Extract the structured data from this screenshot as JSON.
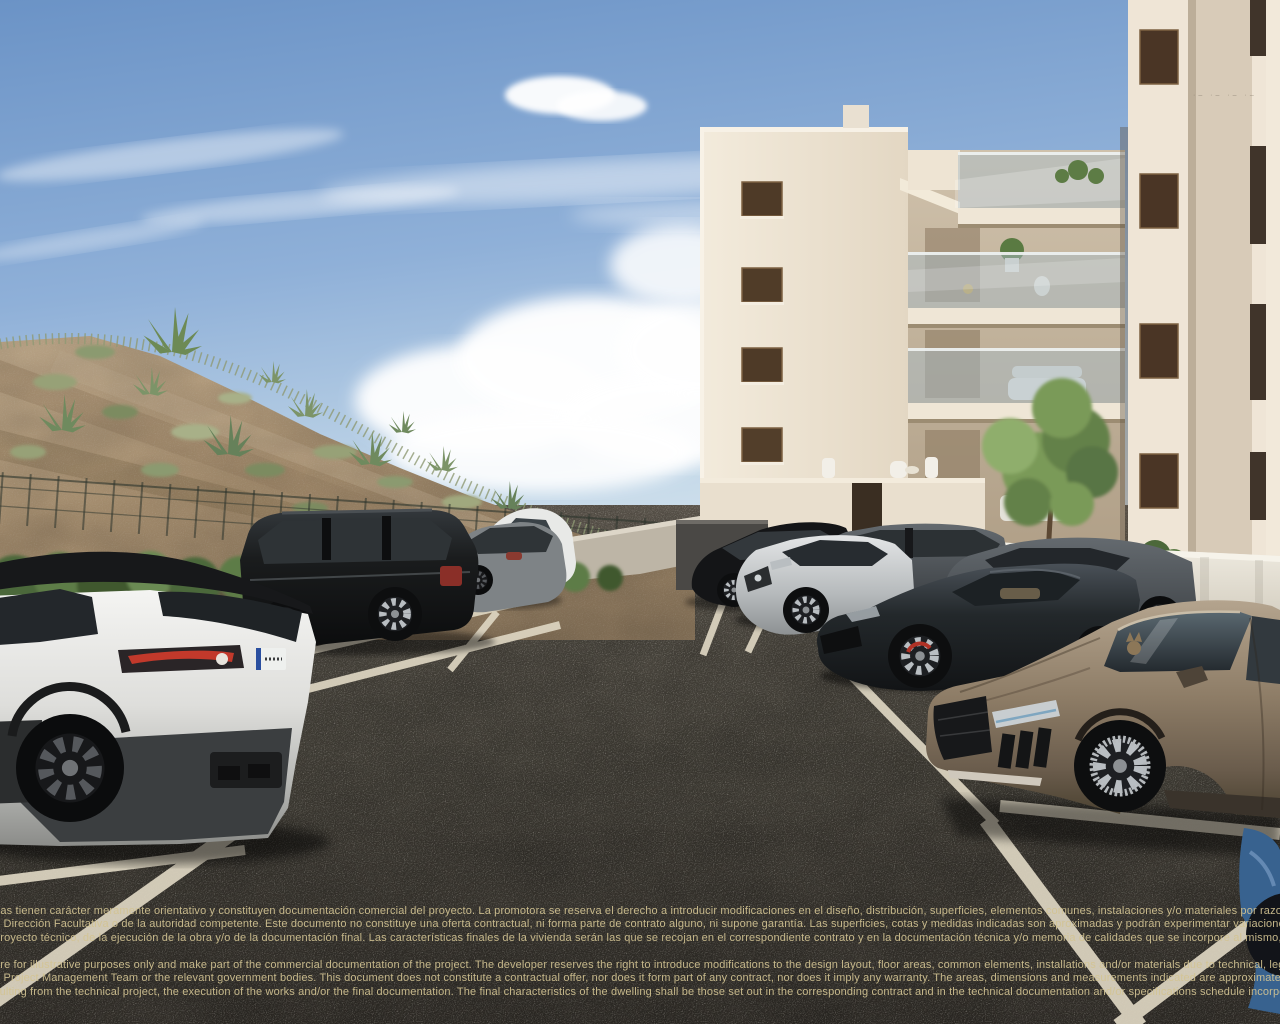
{
  "scene": {
    "type": "3d architectural render",
    "description": "Sunny outdoor parking lot of a new-build cream apartment block with glass balconies; landscaped sandy hillside with agaves and a wire fence on the left; parked cars including a white SUV with black roof in the left foreground, a black SUV, grey sedans, a dark sports coupe and a bronze supercar on the right; bilingual legal disclaimer text overlaid near the bottom of the image."
  },
  "palette": {
    "sky_top": "#6b93c6",
    "sky_horizon": "#d8e6ef",
    "cloud_white": "#ffffff",
    "hill_sand": "#bda583",
    "vegetation_green": "#5d7b45",
    "shrub_dark_green": "#47623a",
    "building_cream": "#ece2d1",
    "building_shadow_cream": "#d9cdb9",
    "window_brown": "#4e3a27",
    "balcony_glass": "#a9bcc6",
    "parapet_white": "#e9e5da",
    "asphalt": "#4a443c",
    "parking_line": "#ded6c2",
    "disclaimer_text": "#d2c394",
    "taillight_red": "#c2392b"
  },
  "vehicles": [
    {
      "name": "white-suv-velar",
      "color": "#e9e9e6",
      "placement": "foreground left, rear view, black roof"
    },
    {
      "name": "black-range-rover",
      "color": "#1a1c1d",
      "placement": "middle left, side view"
    },
    {
      "name": "grey-sedan",
      "color": "#7e8386",
      "placement": "middle, behind black SUV"
    },
    {
      "name": "white-compact",
      "color": "#e8e9e7",
      "placement": "middle, partly hidden"
    },
    {
      "name": "black-sedan",
      "color": "#141517",
      "placement": "center, by building wall"
    },
    {
      "name": "silver-sedan",
      "color": "#c6cacc",
      "placement": "center, nose toward viewer"
    },
    {
      "name": "grey-estate",
      "color": "#63686b",
      "placement": "center right, rear row"
    },
    {
      "name": "grey-coupe",
      "color": "#53585d",
      "placement": "right, along white wall"
    },
    {
      "name": "dark-sports-coupe",
      "color": "#23282b",
      "placement": "right, front row"
    },
    {
      "name": "bronze-supercar",
      "color": "#8d7c66",
      "placement": "foreground right, cat visible behind windshield"
    },
    {
      "name": "blue-car-fragment",
      "color": "#38628f",
      "placement": "bottom right corner edge"
    }
  ],
  "watermark": {
    "text": "·– ·– ·– ·–"
  },
  "disclaimer_es": {
    "lines": [
      "fías tienen carácter meramente orientativo y constituyen documentación comercial del proyecto. La promotora se reserva el derecho a introducir modificaciones en el diseño, distribución, superficies, elementos comunes, instalaciones y/o materiales por razones técnicas o",
      "a Dirección Facultativa o de la autoridad competente. Este documento no constituye una oferta contractual, ni forma parte de contrato alguno, ni supone garantía. Las superficies, cotas y medidas indicadas son aproximadas y podrán experimentar variaciones respecto a",
      "proyecto técnico, de la ejecución de la obra y/o de la documentación final. Las características finales de la vivienda serán las que se recojan en el correspondiente contrato y en la documentación técnica y/o memoria de calidades que se incorpore al mismo, en su caso."
    ]
  },
  "disclaimer_en": {
    "lines": [
      "are for illustrative purposes only and make part of the commercial documentation of the project. The developer reserves the right to introduce modifications to the design layout, floor areas, common elements, installations and/or materials due to technical, legal",
      "e Project Management Team or the relevant government bodies. This document does not constitute a contractual offer, nor does it form part of any contract, nor does it imply any warranty. The areas, dimensions and measurements indicated are approximate and",
      "sulting from the technical project, the execution of the works and/or the final documentation. The final characteristics of the dwelling shall be those set out in the corresponding contract and in the technical documentation and/or specifications schedule incorporated"
    ]
  }
}
